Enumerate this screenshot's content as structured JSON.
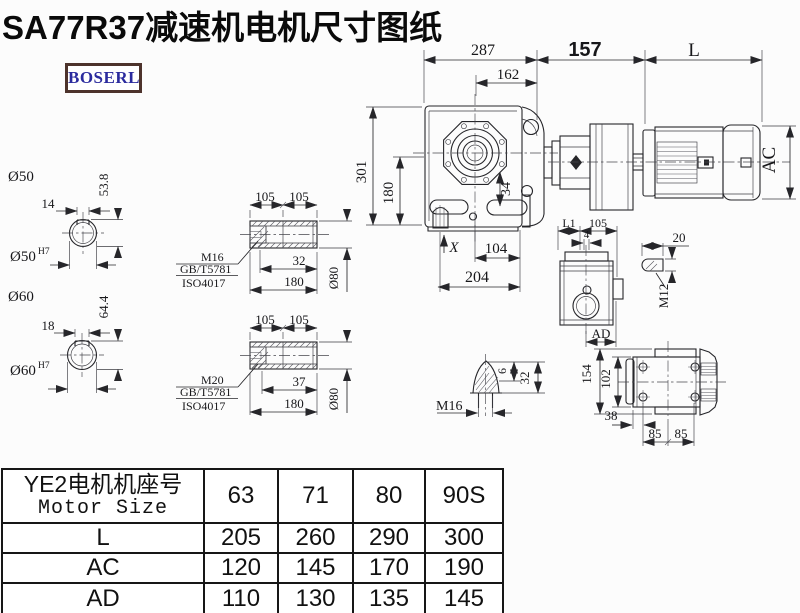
{
  "title": "SA77R37减速机电机尺寸图纸",
  "logo": {
    "text": "BOSERL"
  },
  "colors": {
    "background": "#fcfcfc",
    "line": "#26262a",
    "logo_text": "#2b2b9e",
    "logo_border": "#4d332c"
  },
  "drawing": {
    "main": {
      "d287": "287",
      "d162": "162",
      "d157": "157",
      "dL": "L",
      "d301": "301",
      "d180": "180",
      "d34": "34",
      "dX": "X",
      "d104": "104",
      "d204": "204",
      "dAC": "AC"
    },
    "shaft50": {
      "dia": "Ø50",
      "key_w": "14",
      "key_h": "53.8",
      "bore": "Ø50",
      "tol": "H7"
    },
    "shaft60": {
      "dia": "Ø60",
      "key_w": "18",
      "key_h": "64.4",
      "bore": "Ø60",
      "tol": "H7"
    },
    "hollow_upper": {
      "d105a": "105",
      "d105b": "105",
      "d32": "32",
      "d180": "180",
      "dia": "Ø80",
      "thread": "M16",
      "gb": "GB/T5781",
      "iso": "ISO4017"
    },
    "hollow_lower": {
      "d105a": "105",
      "d105b": "105",
      "d37": "37",
      "d180": "180",
      "dia": "Ø80",
      "thread": "M20",
      "gb": "GB/T5781",
      "iso": "ISO4017"
    },
    "ad_view": {
      "dL1": "L1",
      "d105": "105",
      "d4": "4",
      "dAD": "AD"
    },
    "key": {
      "d20": "20",
      "thread": "M12"
    },
    "plug": {
      "thread": "M16",
      "d6": "6",
      "d32": "32"
    },
    "bottom": {
      "d154": "154",
      "d102": "102",
      "d38": "38",
      "d85a": "85",
      "d85b": "85"
    }
  },
  "table": {
    "header_cn": "YE2电机机座号",
    "header_en": "Motor Size",
    "columns": [
      "63",
      "71",
      "80",
      "90S"
    ],
    "rows": [
      {
        "label": "L",
        "values": [
          "205",
          "260",
          "290",
          "300"
        ]
      },
      {
        "label": "AC",
        "values": [
          "120",
          "145",
          "170",
          "190"
        ]
      },
      {
        "label": "AD",
        "values": [
          "110",
          "130",
          "135",
          "145"
        ]
      }
    ]
  }
}
